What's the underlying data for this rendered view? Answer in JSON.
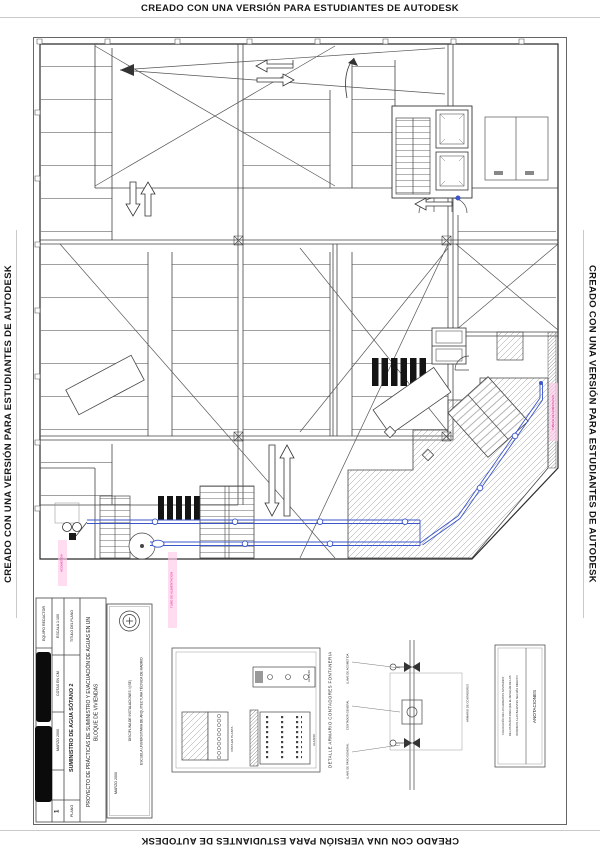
{
  "watermark": {
    "text": "CREADO CON UNA VERSIÓN PARA ESTUDIANTES DE AUTODESK"
  },
  "colors": {
    "pipe_blue": "#3b56c8",
    "annotation_pink": "#d6188f",
    "ink": "#2b2b2b"
  },
  "title_block": {
    "equipo_redactor_label": "EQUIPO REDACTOR",
    "escala": "ESCALA 1:100",
    "cotas": "COTAS EN CM",
    "fecha": "MARZO 2000",
    "titulo_plano_label": "TITULO DEL PLANO",
    "titulo_plano": "SUMINISTRO DE AGUA SÓTANO 2",
    "plano_label": "PLANO",
    "plano_numero": "1",
    "proyecto": "PROYECTO DE PRÁCTICAS DE SUMINISTRO Y EVACUACIÓN DE AGUAS EN UN BLOQUE DE VIVIENDAS",
    "escuela": "ESCUELA UNIVERSITARIA DE ARQUITECTURA TÉCNICA DE MADRID",
    "disciplina": "DISCIPLINA DE INSTALACIONES I (ISE)",
    "fecha_caja": "MARZO 2000"
  },
  "detalle": {
    "titulo": "DETALLE ARMARIO CONTADORES FONTANERIA",
    "vista_planta": "VISTA EN PLANTA",
    "alzado_1": "ALZADO",
    "alzado_2": "ALZADO",
    "valvulas": [
      "LLAVE DE ACOMETIDA",
      "CONTADOR GENERAL",
      "LLAVE DE PASO GENERAL"
    ],
    "armario": "ARMARIO DE CONTADORES"
  },
  "anotaciones": {
    "titulo": "ANOTACIONES",
    "lineas": [
      "COLOCACIÓN DE LOS APARATOS SANITARIOS",
      "DE LOS BAÑOS PARA QUE EL DESAGÜE DE LOS",
      "INODOROS A LAS BAJANTES SEA MÁS DIRECTO"
    ]
  },
  "plano": {
    "etiquetas_rosa": [
      "ACOMETIDA",
      "TUBO DE ALIMENTACION",
      "TUBERIA DE ALIMENTACION"
    ]
  }
}
